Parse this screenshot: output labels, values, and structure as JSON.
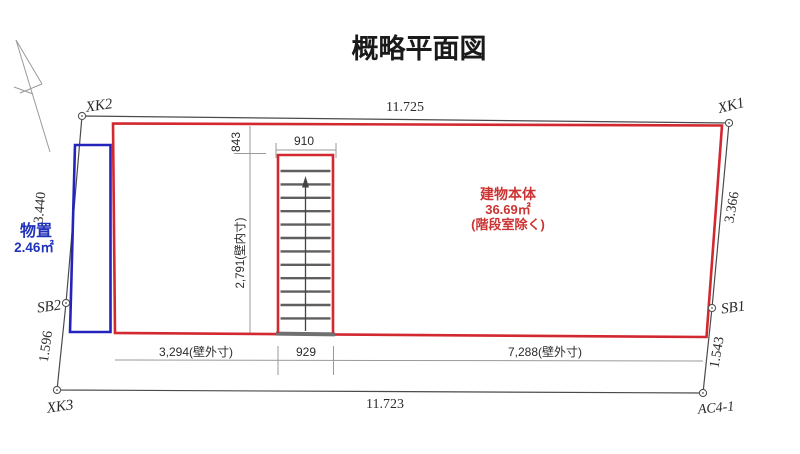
{
  "title": "概略平面図",
  "colors": {
    "building_outline": "#d22830",
    "storage_outline": "#2424bc",
    "boundary_line": "#4a4a4a",
    "dimension_line": "#9a9a9a",
    "building_text": "#cc3333",
    "storage_text": "#2233bb"
  },
  "site": {
    "points": [
      {
        "id": "XK2"
      },
      {
        "id": "XK1"
      },
      {
        "id": "SB1"
      },
      {
        "id": "AC4-1"
      },
      {
        "id": "XK3"
      },
      {
        "id": "SB2"
      }
    ],
    "dims": {
      "top": "11.725",
      "bottom": "11.723",
      "left_upper": "3.440",
      "left_lower": "1.596",
      "right_upper": "3.366",
      "right_lower": "1.543"
    }
  },
  "building": {
    "name": "建物本体",
    "area": "36.69㎡",
    "note": "(階段室除く)",
    "dims": {
      "stair_offset_top": "843",
      "stair_width_top": "910",
      "stair_inner_height": "2,791(壁内寸)",
      "left_outer_width": "3,294(壁外寸)",
      "stair_width_bottom": "929",
      "right_outer_width": "7,288(壁外寸)"
    }
  },
  "storage": {
    "name": "物置",
    "area": "2.46㎡"
  }
}
